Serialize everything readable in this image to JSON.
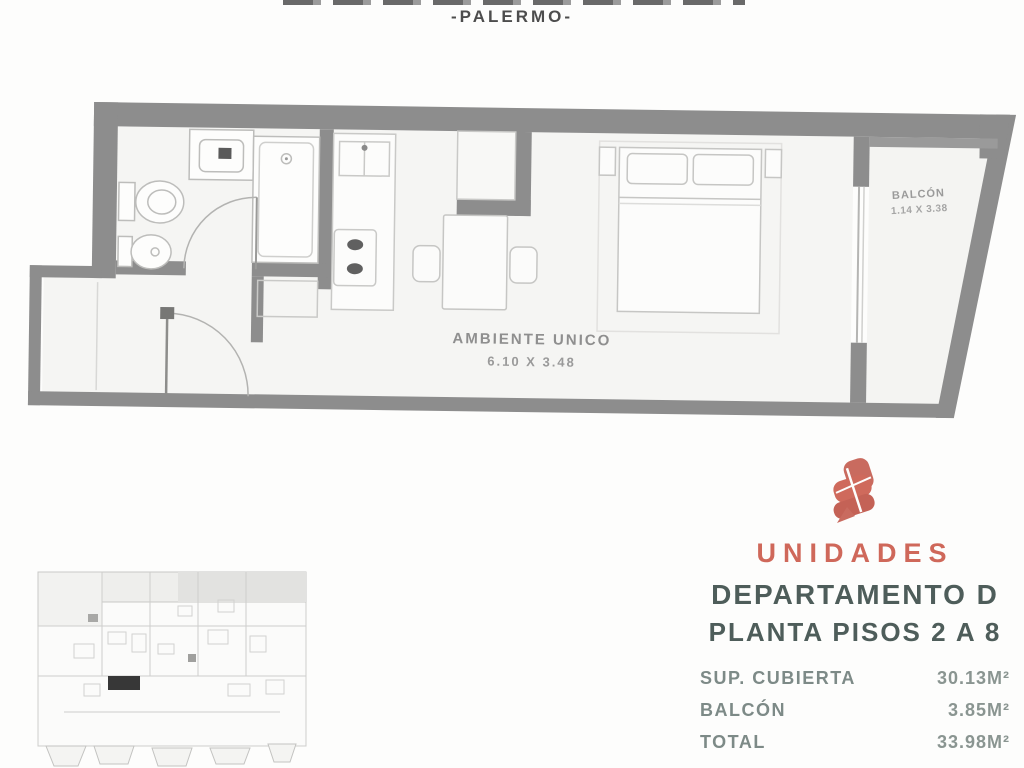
{
  "page": {
    "location": "-PALERMO-"
  },
  "plan": {
    "room_label": "AMBIENTE UNICO",
    "room_dims": "6.10 X 3.48",
    "balcony_label": "BALCÓN",
    "balcony_dims": "1.14 X 3.38"
  },
  "info": {
    "brand": "UNIDADES",
    "unit_title": "DEPARTAMENTO D",
    "unit_subtitle": "PLANTA PISOS 2 A 8",
    "areas": [
      {
        "label": "SUP. CUBIERTA",
        "value": "30.13M²"
      },
      {
        "label": "BALCÓN",
        "value": "3.85M²"
      },
      {
        "label": "TOTAL",
        "value": "33.98M²"
      }
    ]
  },
  "colors": {
    "accent": "#cf685a",
    "heading": "#4e5d5a",
    "table_text": "#7d8a87",
    "wall": "#8d8d8d",
    "highlight_unit": "#151515"
  }
}
